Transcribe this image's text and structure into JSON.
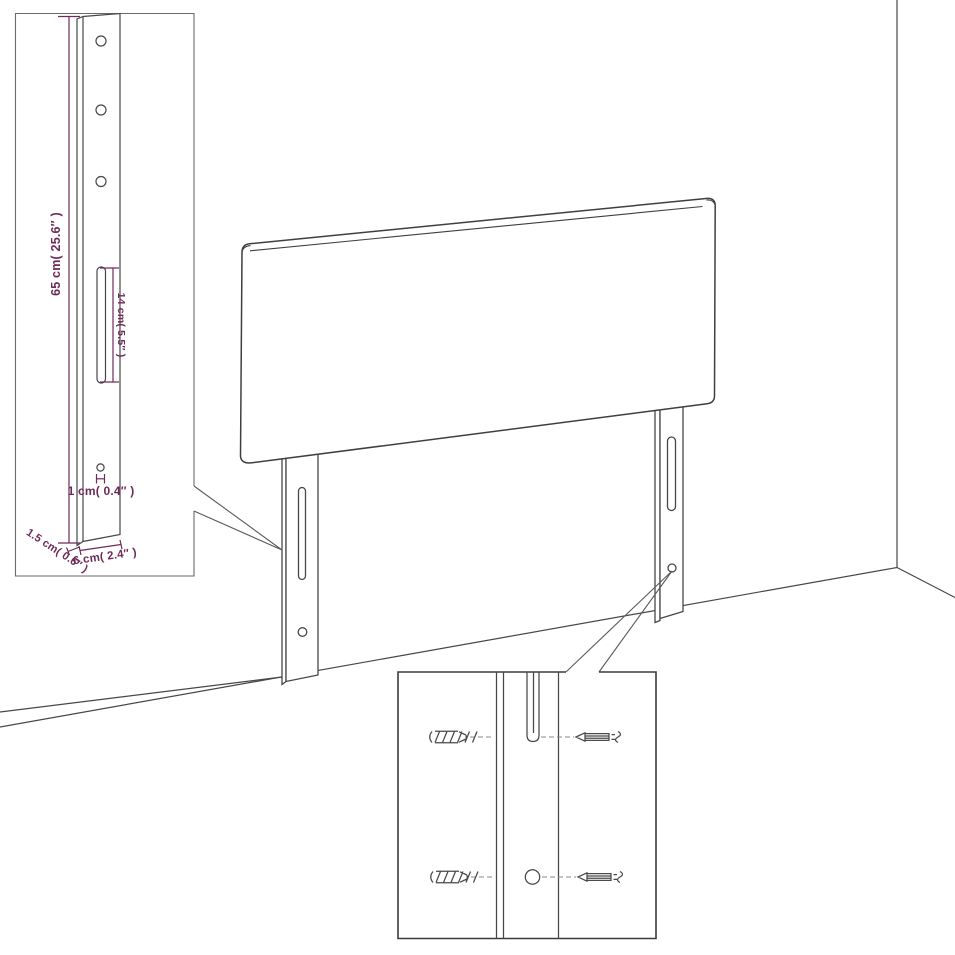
{
  "diagram": {
    "type": "product-dimension-diagram",
    "subject": "upholstered headboard with two wall-mount legs, shown in a room corner",
    "colors": {
      "background": "#ffffff",
      "outline": "#474747",
      "dimension": "#6e2b59",
      "inset_border": "#3b3b3b"
    },
    "labels": {
      "leg_height": "65 cm( 25.6″ )",
      "slot_length": "14 cm( 5.5″ )",
      "hole_diameter": "1 cm( 0.4″ )",
      "leg_thickness": "1.5 cm( 0.6″ )",
      "leg_width": "6 cm( 2.4″ )"
    },
    "insets": {
      "leg_detail": {
        "icon": "bracket-leg-drawing",
        "features": [
          "three-screw-holes",
          "adjustment-slot",
          "small-hole"
        ],
        "dimension_labels": [
          "leg_height",
          "slot_length",
          "hole_diameter",
          "leg_thickness",
          "leg_width"
        ]
      },
      "mounting_detail": {
        "icons": [
          "wall-plug-icon",
          "screw-icon"
        ],
        "features": [
          "slot-with-screw-top-row",
          "hole-with-screw-bottom-row",
          "dashed-alignment-lines"
        ]
      }
    },
    "scene": {
      "icons": [
        "headboard-panel",
        "left-leg",
        "right-leg",
        "wall-corner-line",
        "floor-line"
      ],
      "callouts": [
        "left-leg-to-leg-detail-inset",
        "right-leg-hole-to-mounting-detail-inset"
      ]
    }
  }
}
